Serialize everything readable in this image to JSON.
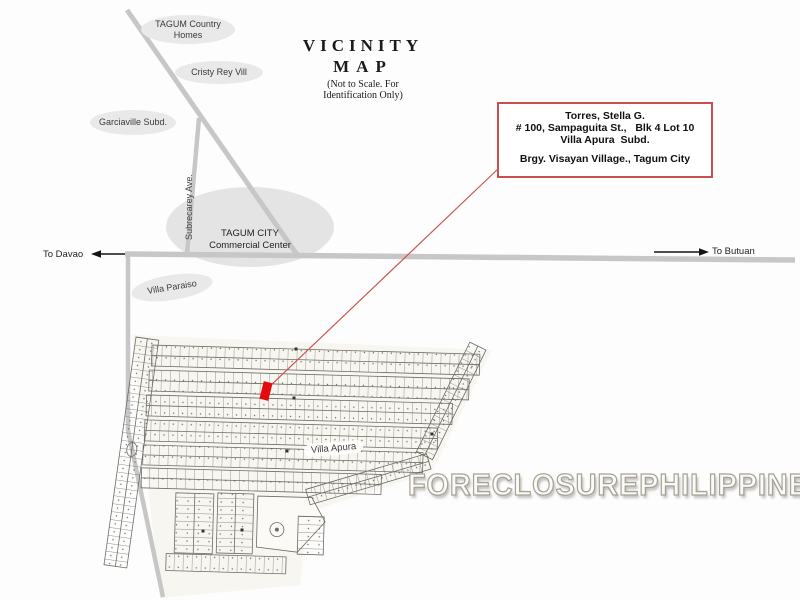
{
  "title": {
    "main": "VICINITY",
    "sub": "MAP",
    "note1": "(Not to Scale. For",
    "note2": "Identification Only)"
  },
  "landmarks": {
    "tagum_country_homes": {
      "line1": "TAGUM Country",
      "line2": "Homes"
    },
    "cristy_rey": {
      "label": "Cristy Rey Vill"
    },
    "garciaville": {
      "label": "Garciaville Subd."
    },
    "villa_paraiso": {
      "label": "Villa Paraiso"
    },
    "commercial_center": {
      "line1": "TAGUM CITY",
      "line2": "Commercial Center"
    }
  },
  "roads": {
    "subrecarey_ave": "Subrecarey Ave.",
    "to_davao": "To Davao",
    "to_butuan": "To Butuan"
  },
  "info_box": {
    "line1": "Torres, Stella G.",
    "line2": "# 100, Sampaguita St.,   Blk 4 Lot 10",
    "line3": "Villa Apura  Subd.",
    "line4": "Brgy. Visayan Village., Tagum City"
  },
  "subdivision": {
    "label": "Villa Apura"
  },
  "watermark": "FORECLOSUREPHILIPPINES.COM",
  "colors": {
    "info_box_border": "#c94f4f",
    "callout_line": "#cc5353",
    "property_marker": "#e20a0a",
    "road_gray": "#c7c7c7",
    "landmark_fill": "#e9e9e9",
    "plat_ink": "#6f6c63"
  }
}
